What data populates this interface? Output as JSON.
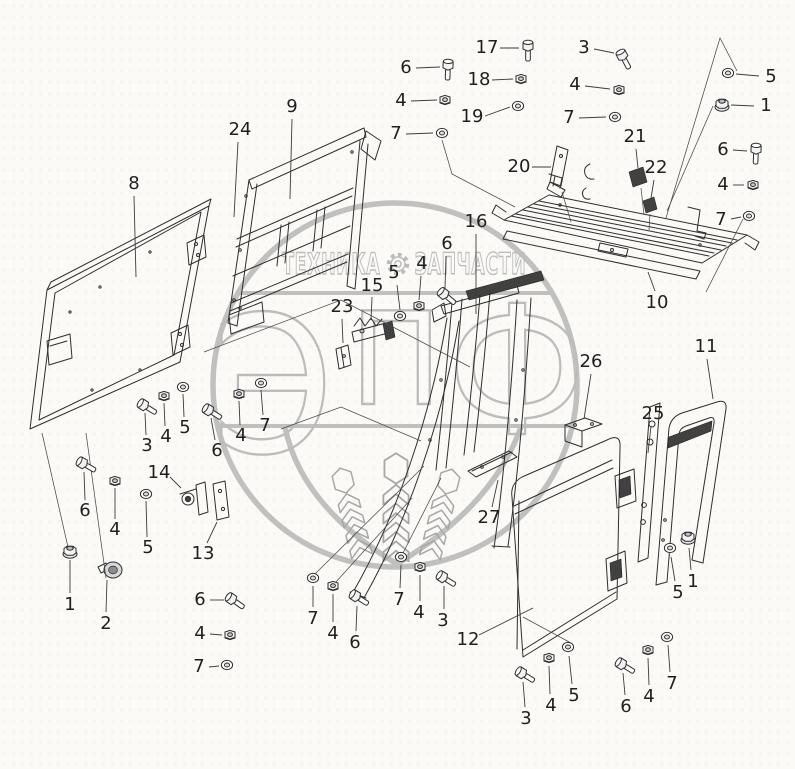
{
  "watermark": {
    "color": "#b9b9b9",
    "top_left_text": "ТЕХНИКА",
    "top_right_text": "ЗАПЧАСТИ",
    "logo_letters": [
      "Э",
      "П",
      "Ф"
    ]
  },
  "callouts": [
    {
      "n": "8",
      "x": 134,
      "y": 184,
      "lead": [
        [
          134,
          196
        ],
        [
          136,
          277
        ]
      ]
    },
    {
      "n": "24",
      "x": 240,
      "y": 130,
      "lead": [
        [
          238,
          142
        ],
        [
          234,
          217
        ]
      ]
    },
    {
      "n": "9",
      "x": 292,
      "y": 107,
      "lead": [
        [
          292,
          119
        ],
        [
          290,
          199
        ]
      ]
    },
    {
      "n": "6",
      "x": 406,
      "y": 68,
      "lead": [
        [
          416,
          68
        ],
        [
          440,
          67
        ]
      ]
    },
    {
      "n": "4",
      "x": 401,
      "y": 101,
      "lead": [
        [
          411,
          101
        ],
        [
          437,
          100
        ]
      ]
    },
    {
      "n": "7",
      "x": 396,
      "y": 134,
      "lead": [
        [
          406,
          134
        ],
        [
          433,
          133
        ]
      ]
    },
    {
      "n": "17",
      "x": 487,
      "y": 48,
      "lead": [
        [
          500,
          48
        ],
        [
          519,
          48
        ]
      ]
    },
    {
      "n": "18",
      "x": 479,
      "y": 80,
      "lead": [
        [
          492,
          80
        ],
        [
          513,
          79
        ]
      ]
    },
    {
      "n": "19",
      "x": 472,
      "y": 117,
      "lead": [
        [
          485,
          116
        ],
        [
          510,
          107
        ]
      ]
    },
    {
      "n": "20",
      "x": 519,
      "y": 167,
      "lead": [
        [
          532,
          167
        ],
        [
          551,
          167
        ]
      ]
    },
    {
      "n": "3",
      "x": 584,
      "y": 48,
      "lead": [
        [
          594,
          49
        ],
        [
          614,
          53
        ]
      ]
    },
    {
      "n": "4",
      "x": 575,
      "y": 85,
      "lead": [
        [
          585,
          86
        ],
        [
          610,
          89
        ]
      ]
    },
    {
      "n": "7",
      "x": 569,
      "y": 118,
      "lead": [
        [
          579,
          118
        ],
        [
          606,
          117
        ]
      ]
    },
    {
      "n": "21",
      "x": 635,
      "y": 137,
      "lead": [
        [
          636,
          149
        ],
        [
          638,
          168
        ]
      ]
    },
    {
      "n": "22",
      "x": 656,
      "y": 168,
      "lead": [
        [
          654,
          180
        ],
        [
          651,
          198
        ]
      ]
    },
    {
      "n": "5",
      "x": 771,
      "y": 77,
      "lead": [
        [
          759,
          76
        ],
        [
          736,
          74
        ]
      ]
    },
    {
      "n": "1",
      "x": 766,
      "y": 106,
      "lead": [
        [
          754,
          106
        ],
        [
          731,
          105
        ]
      ]
    },
    {
      "n": "6",
      "x": 723,
      "y": 150,
      "lead": [
        [
          733,
          150
        ],
        [
          747,
          151
        ]
      ]
    },
    {
      "n": "4",
      "x": 723,
      "y": 185,
      "lead": [
        [
          733,
          185
        ],
        [
          744,
          185
        ]
      ]
    },
    {
      "n": "7",
      "x": 721,
      "y": 220,
      "lead": [
        [
          731,
          219
        ],
        [
          741,
          217
        ]
      ]
    },
    {
      "n": "16",
      "x": 476,
      "y": 222,
      "lead": [
        [
          476,
          234
        ],
        [
          476,
          314
        ]
      ]
    },
    {
      "n": "15",
      "x": 372,
      "y": 286,
      "lead": [
        [
          372,
          297
        ],
        [
          371,
          320
        ]
      ]
    },
    {
      "n": "5",
      "x": 394,
      "y": 273,
      "lead": [
        [
          397,
          285
        ],
        [
          400,
          310
        ]
      ]
    },
    {
      "n": "4",
      "x": 422,
      "y": 264,
      "lead": [
        [
          421,
          276
        ],
        [
          419,
          300
        ]
      ]
    },
    {
      "n": "6",
      "x": 447,
      "y": 244,
      "lead": [
        [
          446,
          256
        ],
        [
          445,
          288
        ]
      ]
    },
    {
      "n": "23",
      "x": 342,
      "y": 307,
      "lead": [
        [
          342,
          319
        ],
        [
          343,
          343
        ]
      ]
    },
    {
      "n": "3",
      "x": 147,
      "y": 446,
      "lead": [
        [
          146,
          435
        ],
        [
          145,
          413
        ]
      ]
    },
    {
      "n": "4",
      "x": 166,
      "y": 437,
      "lead": [
        [
          165,
          426
        ],
        [
          164,
          403
        ]
      ]
    },
    {
      "n": "5",
      "x": 185,
      "y": 428,
      "lead": [
        [
          184,
          417
        ],
        [
          183,
          394
        ]
      ]
    },
    {
      "n": "6",
      "x": 217,
      "y": 451,
      "lead": [
        [
          215,
          440
        ],
        [
          211,
          418
        ]
      ]
    },
    {
      "n": "4",
      "x": 241,
      "y": 436,
      "lead": [
        [
          240,
          425
        ],
        [
          239,
          401
        ]
      ]
    },
    {
      "n": "7",
      "x": 265,
      "y": 426,
      "lead": [
        [
          263,
          415
        ],
        [
          261,
          390
        ]
      ]
    },
    {
      "n": "6",
      "x": 85,
      "y": 511,
      "lead": [
        [
          85,
          500
        ],
        [
          84,
          472
        ]
      ]
    },
    {
      "n": "4",
      "x": 115,
      "y": 530,
      "lead": [
        [
          115,
          519
        ],
        [
          115,
          488
        ]
      ]
    },
    {
      "n": "5",
      "x": 148,
      "y": 548,
      "lead": [
        [
          147,
          537
        ],
        [
          146,
          501
        ]
      ]
    },
    {
      "n": "14",
      "x": 159,
      "y": 473,
      "lead": [
        [
          170,
          477
        ],
        [
          181,
          488
        ]
      ]
    },
    {
      "n": "13",
      "x": 203,
      "y": 554,
      "lead": [
        [
          207,
          543
        ],
        [
          217,
          522
        ]
      ]
    },
    {
      "n": "1",
      "x": 70,
      "y": 605,
      "lead": [
        [
          70,
          593
        ],
        [
          70,
          560
        ]
      ]
    },
    {
      "n": "2",
      "x": 106,
      "y": 624,
      "lead": [
        [
          106,
          612
        ],
        [
          107,
          580
        ]
      ]
    },
    {
      "n": "6",
      "x": 200,
      "y": 600,
      "lead": [
        [
          210,
          600
        ],
        [
          224,
          600
        ]
      ]
    },
    {
      "n": "4",
      "x": 200,
      "y": 634,
      "lead": [
        [
          210,
          634
        ],
        [
          222,
          635
        ]
      ]
    },
    {
      "n": "7",
      "x": 199,
      "y": 667,
      "lead": [
        [
          209,
          667
        ],
        [
          219,
          666
        ]
      ]
    },
    {
      "n": "7",
      "x": 313,
      "y": 619,
      "lead": [
        [
          313,
          607
        ],
        [
          313,
          586
        ]
      ]
    },
    {
      "n": "4",
      "x": 333,
      "y": 634,
      "lead": [
        [
          333,
          622
        ],
        [
          333,
          594
        ]
      ]
    },
    {
      "n": "6",
      "x": 355,
      "y": 643,
      "lead": [
        [
          356,
          631
        ],
        [
          357,
          606
        ]
      ]
    },
    {
      "n": "7",
      "x": 399,
      "y": 600,
      "lead": [
        [
          400,
          588
        ],
        [
          401,
          565
        ]
      ]
    },
    {
      "n": "4",
      "x": 419,
      "y": 613,
      "lead": [
        [
          420,
          601
        ],
        [
          420,
          575
        ]
      ]
    },
    {
      "n": "3",
      "x": 443,
      "y": 621,
      "lead": [
        [
          444,
          609
        ],
        [
          444,
          586
        ]
      ]
    },
    {
      "n": "12",
      "x": 468,
      "y": 640,
      "lead": [
        [
          479,
          635
        ],
        [
          533,
          608
        ]
      ]
    },
    {
      "n": "27",
      "x": 489,
      "y": 518,
      "lead": [
        [
          492,
          507
        ],
        [
          498,
          480
        ]
      ]
    },
    {
      "n": "3",
      "x": 526,
      "y": 719,
      "lead": [
        [
          525,
          707
        ],
        [
          523,
          682
        ]
      ]
    },
    {
      "n": "4",
      "x": 551,
      "y": 706,
      "lead": [
        [
          550,
          694
        ],
        [
          549,
          666
        ]
      ]
    },
    {
      "n": "5",
      "x": 574,
      "y": 696,
      "lead": [
        [
          572,
          684
        ],
        [
          569,
          656
        ]
      ]
    },
    {
      "n": "6",
      "x": 626,
      "y": 707,
      "lead": [
        [
          625,
          695
        ],
        [
          623,
          673
        ]
      ]
    },
    {
      "n": "4",
      "x": 649,
      "y": 697,
      "lead": [
        [
          649,
          685
        ],
        [
          648,
          658
        ]
      ]
    },
    {
      "n": "7",
      "x": 672,
      "y": 684,
      "lead": [
        [
          670,
          672
        ],
        [
          668,
          645
        ]
      ]
    },
    {
      "n": "10",
      "x": 657,
      "y": 303,
      "lead": [
        [
          655,
          291
        ],
        [
          648,
          272
        ]
      ]
    },
    {
      "n": "11",
      "x": 706,
      "y": 347,
      "lead": [
        [
          707,
          359
        ],
        [
          713,
          399
        ]
      ]
    },
    {
      "n": "26",
      "x": 591,
      "y": 362,
      "lead": [
        [
          591,
          374
        ],
        [
          584,
          419
        ]
      ]
    },
    {
      "n": "25",
      "x": 653,
      "y": 414,
      "lead": [
        [
          651,
          426
        ],
        [
          648,
          453
        ]
      ]
    },
    {
      "n": "5",
      "x": 678,
      "y": 593,
      "lead": [
        [
          675,
          581
        ],
        [
          671,
          557
        ]
      ]
    },
    {
      "n": "1",
      "x": 693,
      "y": 582,
      "lead": [
        [
          691,
          570
        ],
        [
          689,
          548
        ]
      ]
    }
  ],
  "fasteners": [
    {
      "type": "bolt",
      "x": 448,
      "y": 67,
      "r": 92
    },
    {
      "type": "bolt",
      "x": 528,
      "y": 48,
      "r": 90
    },
    {
      "type": "bolt",
      "x": 623,
      "y": 57,
      "r": 62
    },
    {
      "type": "bolt",
      "x": 756,
      "y": 151,
      "r": 92
    },
    {
      "type": "bolt",
      "x": 445,
      "y": 295,
      "r": 40
    },
    {
      "type": "bolt",
      "x": 145,
      "y": 406,
      "r": 32
    },
    {
      "type": "bolt",
      "x": 210,
      "y": 411,
      "r": 32
    },
    {
      "type": "bolt",
      "x": 84,
      "y": 464,
      "r": 30
    },
    {
      "type": "bolt",
      "x": 233,
      "y": 600,
      "r": 35
    },
    {
      "type": "bolt",
      "x": 357,
      "y": 597,
      "r": 32
    },
    {
      "type": "bolt",
      "x": 444,
      "y": 578,
      "r": 32
    },
    {
      "type": "bolt",
      "x": 523,
      "y": 674,
      "r": 32
    },
    {
      "type": "bolt",
      "x": 623,
      "y": 665,
      "r": 32
    },
    {
      "type": "nut",
      "x": 445,
      "y": 100
    },
    {
      "type": "nut",
      "x": 521,
      "y": 79
    },
    {
      "type": "nut",
      "x": 619,
      "y": 90
    },
    {
      "type": "nut",
      "x": 753,
      "y": 185
    },
    {
      "type": "nut",
      "x": 419,
      "y": 306
    },
    {
      "type": "nut",
      "x": 164,
      "y": 396
    },
    {
      "type": "nut",
      "x": 239,
      "y": 394
    },
    {
      "type": "nut",
      "x": 115,
      "y": 481
    },
    {
      "type": "nut",
      "x": 230,
      "y": 635
    },
    {
      "type": "nut",
      "x": 333,
      "y": 586
    },
    {
      "type": "nut",
      "x": 420,
      "y": 567
    },
    {
      "type": "nut",
      "x": 549,
      "y": 658
    },
    {
      "type": "nut",
      "x": 648,
      "y": 650
    },
    {
      "type": "flange_nut",
      "x": 722,
      "y": 105
    },
    {
      "type": "flange_nut",
      "x": 70,
      "y": 552
    },
    {
      "type": "flange_nut",
      "x": 688,
      "y": 538
    },
    {
      "type": "washer",
      "x": 442,
      "y": 133
    },
    {
      "type": "washer",
      "x": 518,
      "y": 106
    },
    {
      "type": "washer",
      "x": 615,
      "y": 117
    },
    {
      "type": "washer",
      "x": 728,
      "y": 73
    },
    {
      "type": "washer",
      "x": 749,
      "y": 216
    },
    {
      "type": "washer",
      "x": 400,
      "y": 316
    },
    {
      "type": "washer",
      "x": 183,
      "y": 387
    },
    {
      "type": "washer",
      "x": 261,
      "y": 383
    },
    {
      "type": "washer",
      "x": 146,
      "y": 494
    },
    {
      "type": "washer",
      "x": 227,
      "y": 665
    },
    {
      "type": "washer",
      "x": 313,
      "y": 578
    },
    {
      "type": "washer",
      "x": 401,
      "y": 557
    },
    {
      "type": "washer",
      "x": 568,
      "y": 647
    },
    {
      "type": "washer",
      "x": 667,
      "y": 637
    },
    {
      "type": "washer",
      "x": 670,
      "y": 548
    }
  ]
}
